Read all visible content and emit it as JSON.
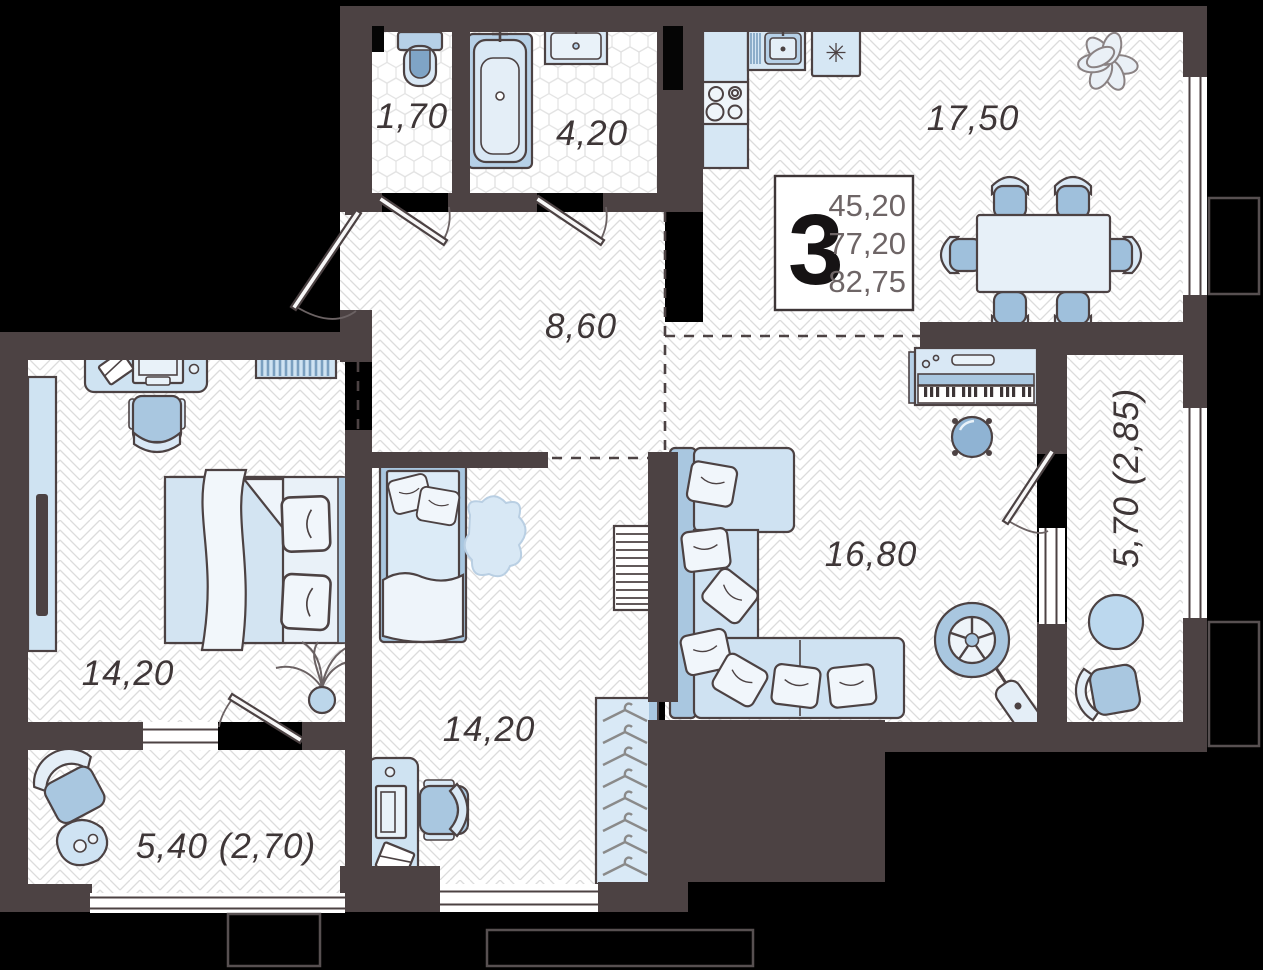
{
  "unit_summary": {
    "rooms_count": "3",
    "living_area": "45,20",
    "apartment_area": "77,20",
    "total_area": "82,75"
  },
  "room_areas": {
    "wc": "1,70",
    "bathroom": "4,20",
    "kitchen_dining": "17,50",
    "hallway": "8,60",
    "bedroom_left": "14,20",
    "living_room": "16,80",
    "bedroom_bottom": "14,20",
    "balcony_bottom": "5,40 (2,70)",
    "loggia_right": "5,70 (2,85)"
  },
  "icons": {
    "freezer_snowflake": "✳"
  },
  "colors": {
    "background": "#000000",
    "wall": "#4c4243",
    "floor": "#ffffff",
    "floor_pattern_line": "#dcdcdc",
    "furniture_light": "#d9e8f5",
    "furniture_lighter": "#edf4fa",
    "furniture_mid": "#a9c7e0",
    "furniture_deep": "#8fb3d3",
    "label_text": "#3e3637",
    "info_numbers": "#6e6566"
  }
}
